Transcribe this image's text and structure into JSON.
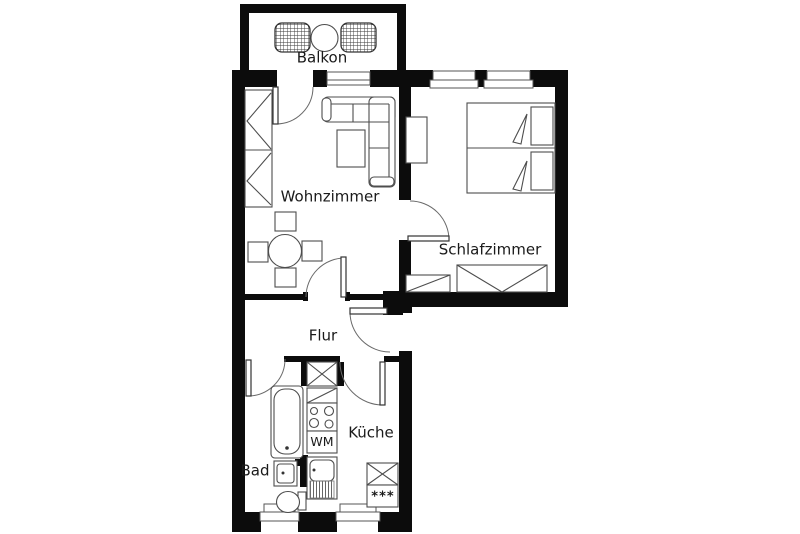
{
  "plan": {
    "type": "apartment-floor-plan",
    "background_color": "#ffffff",
    "wall_color": "#0c0c0c",
    "line_color": "#4d4d4d",
    "text_color": "#1a1a1a"
  },
  "rooms": {
    "balkon": {
      "label": "Balkon"
    },
    "wohnzimmer": {
      "label": "Wohnzimmer"
    },
    "schlafzimmer": {
      "label": "Schlafzimmer"
    },
    "flur": {
      "label": "Flur"
    },
    "kueche": {
      "label": "Küche"
    },
    "bad": {
      "label": "Bad"
    }
  },
  "appliances": {
    "washing_machine": {
      "label": "WM"
    },
    "freezer": {
      "label": "***"
    }
  }
}
